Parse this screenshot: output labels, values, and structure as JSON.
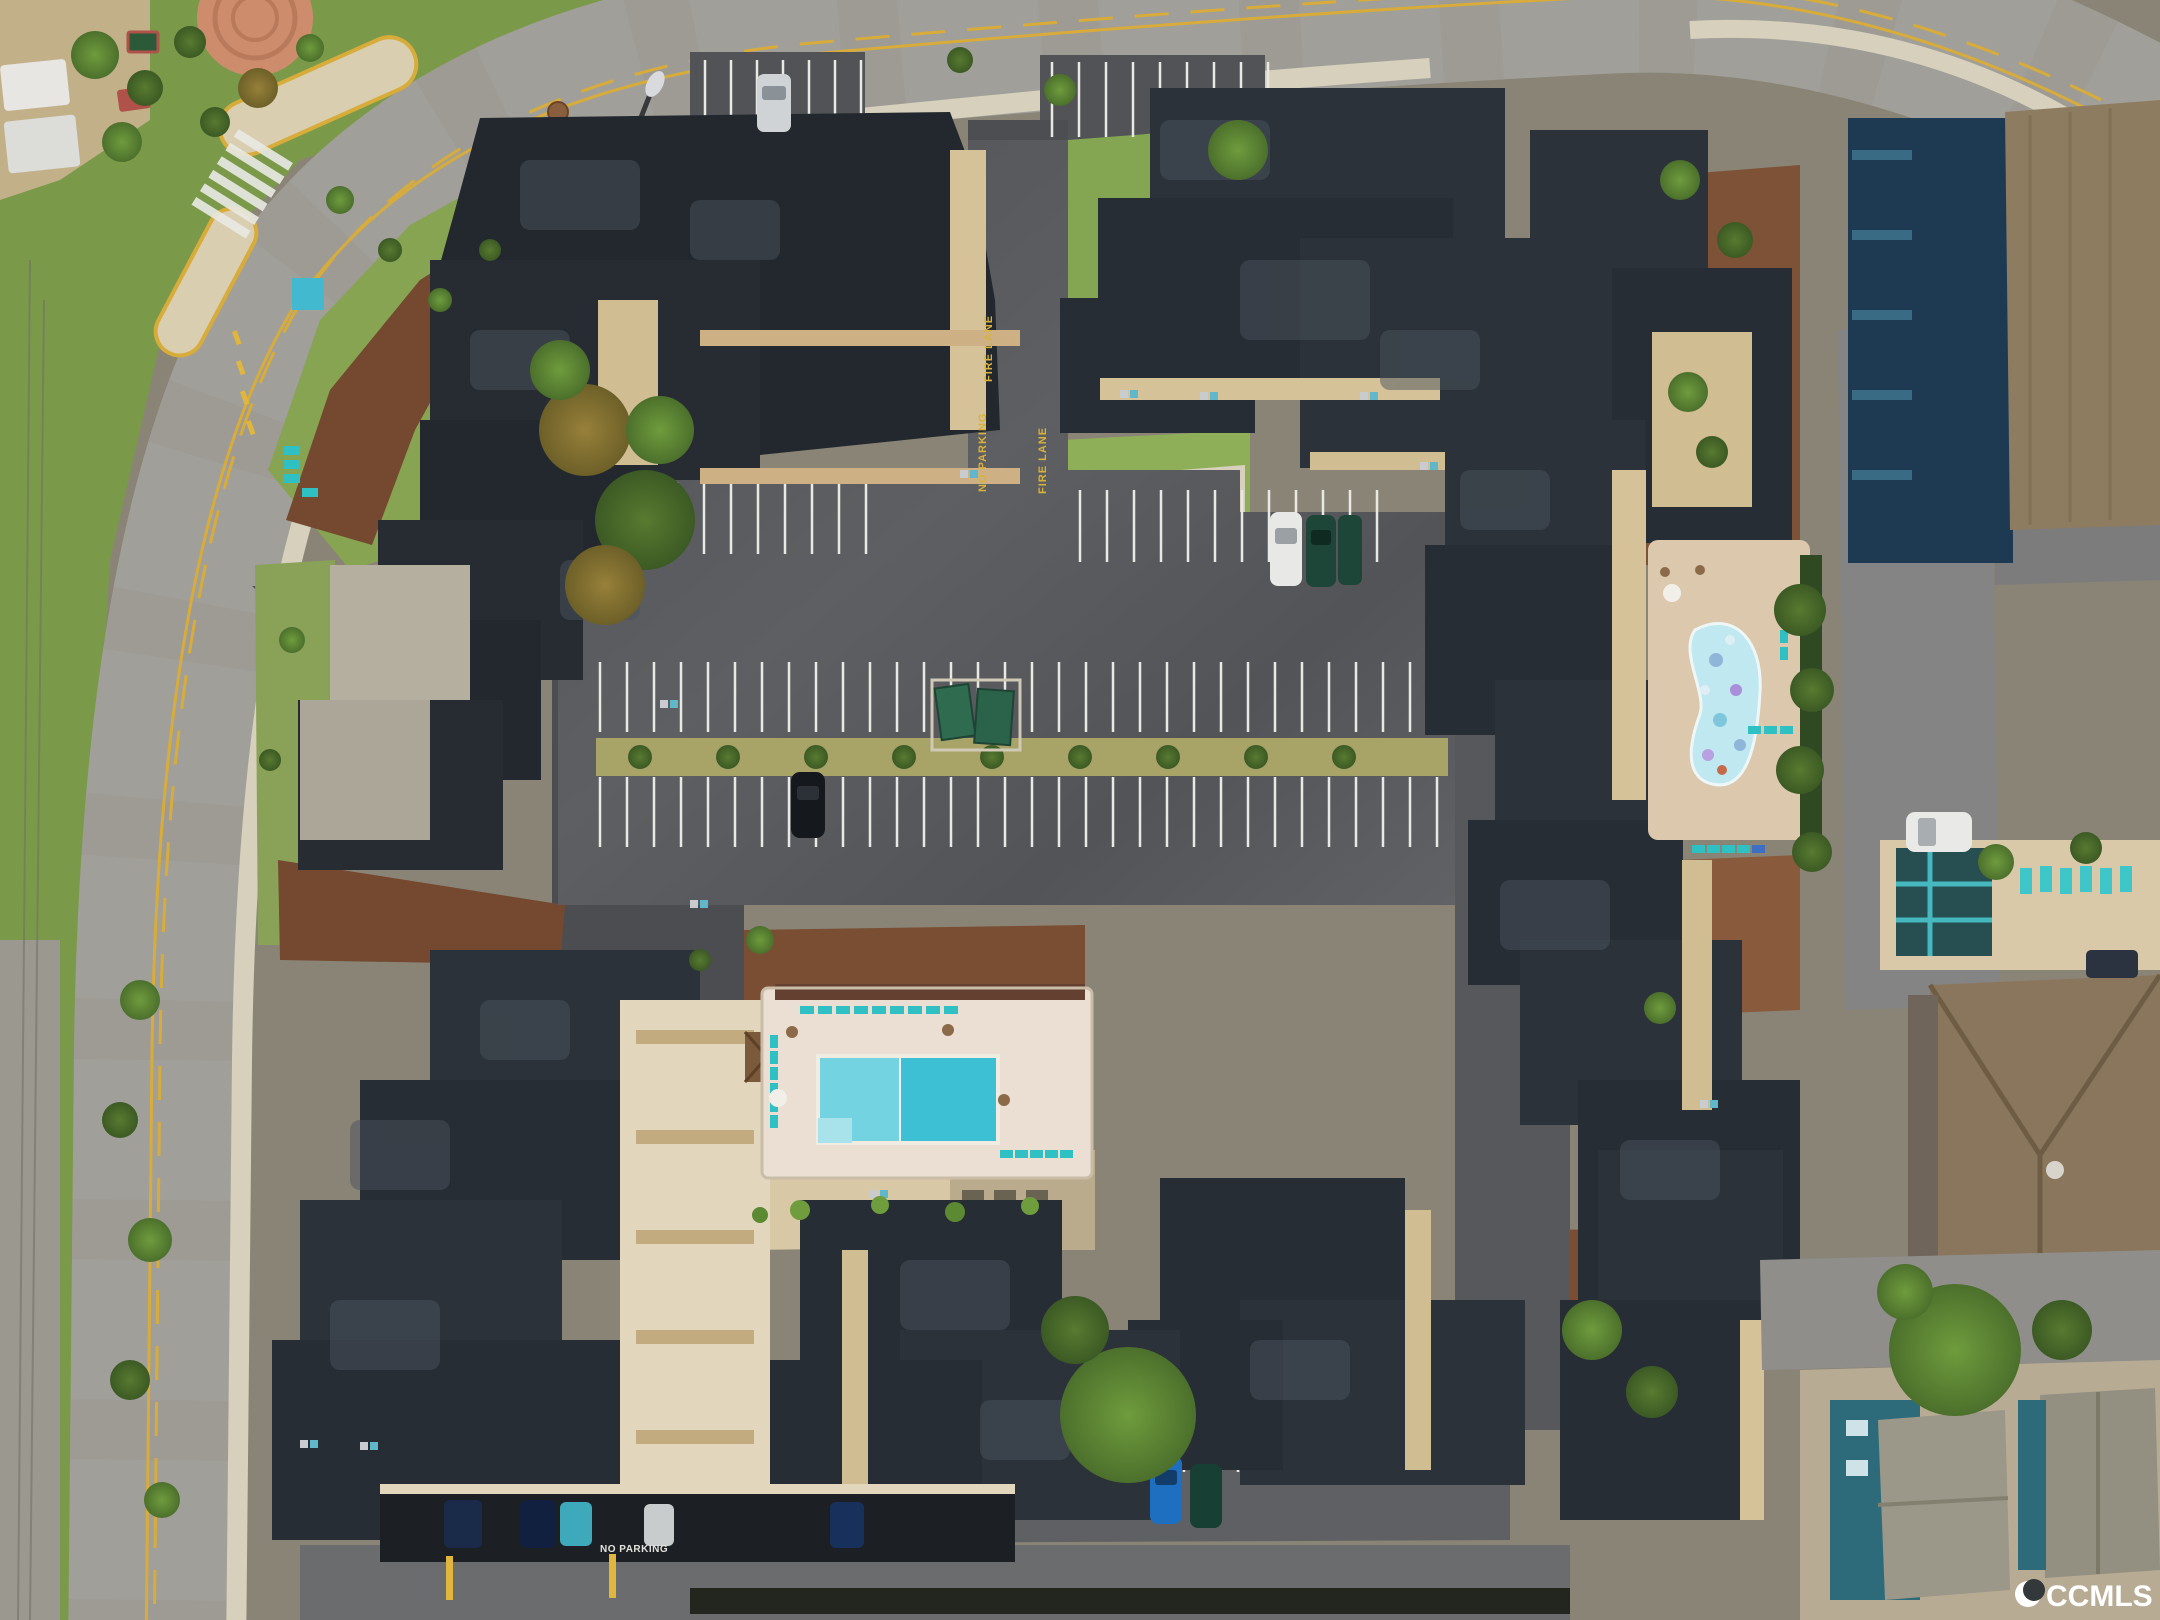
{
  "scene": {
    "type": "aerial-drone-photograph",
    "description": "Overhead view of a beachside condominium complex: dark flat-roof stair-stepped buildings, central striped parking lot with landscaped median, rectangular community pool with teal loungers, kidney-shaped pool on paver deck, curved perimeter street, neighboring buildings and beach houses on the right."
  },
  "watermark": {
    "text": "CCMLS",
    "logo_icon": "crescent-moon-icon"
  },
  "markings": {
    "fire_lane_1": "FIRE LANE",
    "fire_lane_2": "FIRE LANE",
    "no_parking_yellow": "NO PARKING",
    "no_parking_white": "NO PARKING"
  },
  "palette": {
    "street_gray": "#a19f99",
    "sidewalk_tan": "#d8d2bf",
    "median_tan": "#d9cfb0",
    "line_yellow": "#d8ac3a",
    "asphalt_dark": "#54565a",
    "asphalt_light": "#6a6c6e",
    "stripe_white": "#e9e9e4",
    "roof_charcoal": "#272d34",
    "roof_slate": "#343b43",
    "wall_tan": "#d5c298",
    "walk_cream": "#e8dfc9",
    "grass_green": "#7da24a",
    "grass_dry": "#b3a96b",
    "mulch_brown": "#6f4730",
    "pool_teal": "#3fc3d6",
    "pool_sparkle": "#c2e9f1",
    "deck_cream": "#eadfd2",
    "paver_tan": "#dcc8ac",
    "lounger_teal": "#2fc0c4",
    "neighbor_navy": "#1d3a52",
    "neighbor_brown_roof": "#8d7c60",
    "house_teal_siding": "#2e6b7a"
  },
  "inventory": {
    "building_clusters": 9,
    "pools": {
      "main_rectangular": 1,
      "kidney_shaped": 1,
      "neighbor_lap_pool": 1,
      "kiddie_pool": 1
    },
    "parking_rows": 7,
    "median_shrubs": 9,
    "dumpsters": 2,
    "gazebo": 1,
    "yellow_bollards": 2,
    "cars": [
      {
        "color": "silver",
        "location": "top lot"
      },
      {
        "color": "white",
        "location": "upper row"
      },
      {
        "color": "dark-green",
        "location": "upper row"
      },
      {
        "color": "dark-green",
        "location": "upper row"
      },
      {
        "color": "black",
        "location": "middle row"
      },
      {
        "color": "blue",
        "location": "bottom lot"
      },
      {
        "color": "dark-green",
        "location": "bottom lot"
      },
      {
        "color": "navy",
        "location": "carport"
      },
      {
        "color": "navy",
        "location": "carport"
      },
      {
        "color": "teal",
        "location": "carport"
      },
      {
        "color": "silver",
        "location": "carport"
      },
      {
        "color": "white-suv",
        "location": "right drive"
      }
    ]
  }
}
